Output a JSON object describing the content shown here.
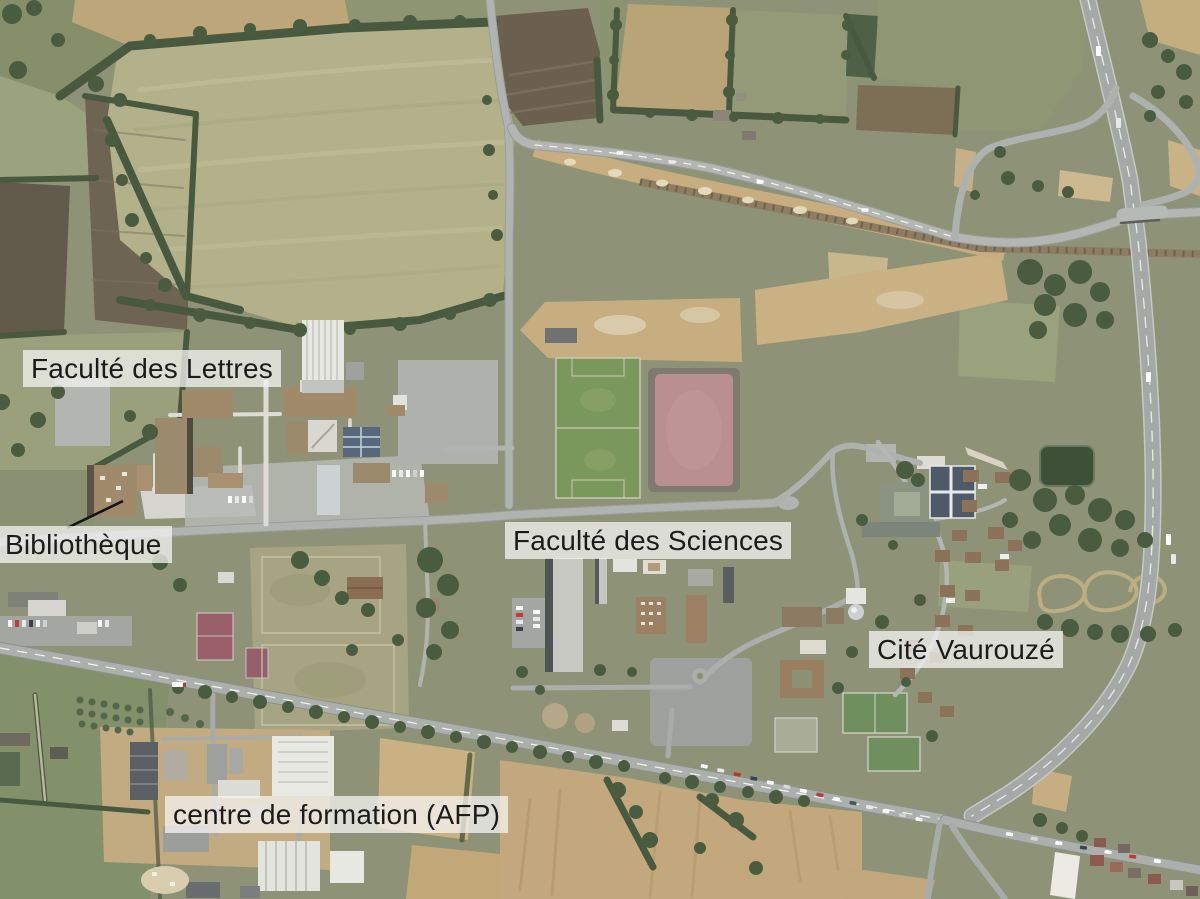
{
  "map": {
    "kind": "annotated aerial photograph",
    "subject": "university campus and surroundings",
    "labels": [
      {
        "name": "faculte-des-lettres",
        "text": "Faculté des Lettres"
      },
      {
        "name": "bibliotheque",
        "text": "Bibliothèque",
        "has_leader_line": true
      },
      {
        "name": "faculte-des-sciences",
        "text": "Faculté des Sciences"
      },
      {
        "name": "cite-vaurouze",
        "text": "Cité Vaurouzé"
      },
      {
        "name": "centre-de-formation-afp",
        "text": "centre de formation (AFP)"
      }
    ],
    "style": {
      "label_background": "rgba(244,244,241,0.75)",
      "label_text_color": "#1b1b1b",
      "leader_line_color": "#141414"
    },
    "visible_features": [
      "farm fields",
      "hedgerows",
      "football pitch",
      "athletics track",
      "tennis courts",
      "campus buildings",
      "gymnasium",
      "library",
      "parking lots",
      "highway interchange",
      "railway under construction",
      "pond",
      "residential houses",
      "traffic queue"
    ]
  }
}
